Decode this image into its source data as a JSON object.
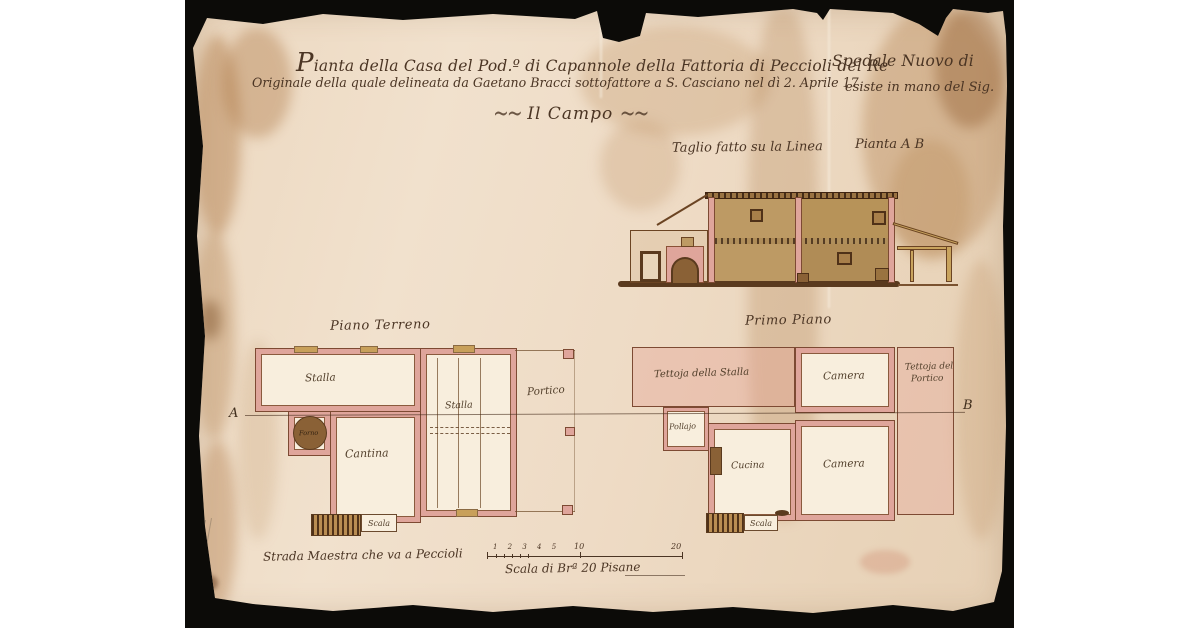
{
  "title": {
    "line1_left": "Pianta della Casa del Pod.º di Capannole della Fattoria di Peccioli del Re",
    "line1_right": "Spedale Nuovo di",
    "line2_left": "Originale della quale delineata da Gaetano Bracci sottofattore a S. Casciano nel dì 2. Aprile 17",
    "line2_right": "esiste in mano del Sig.",
    "line3": "Il Campo",
    "flourish_left": "~~",
    "flourish_right": "~~"
  },
  "section": {
    "caption_left": "Taglio fatto su la Linea",
    "caption_right": "Pianta A B"
  },
  "markers": {
    "a": "A",
    "b": "B"
  },
  "plans": {
    "ground_floor": {
      "title": "Piano Terreno",
      "rooms": {
        "stalla_left": "Stalla",
        "stalla_center": "Stalla",
        "portico": "Portico",
        "forno": "Forno",
        "cantina": "Cantina",
        "scala": "Scala"
      }
    },
    "first_floor": {
      "title": "Primo Piano",
      "rooms": {
        "tettoja_stalla": "Tettoja della Stalla",
        "camera_top": "Camera",
        "tettoja_portico_line1": "Tettoja del",
        "tettoja_portico_line2": "Portico",
        "pollajo": "Pollajo",
        "cucina": "Cucina",
        "camera_bottom": "Camera",
        "scala": "Scala"
      }
    }
  },
  "footer": {
    "road_label": "Strada Maestra che va a Peccioli",
    "scale_label": "Scala di Brª 20 Pisane",
    "scale_ticks_small": "1 2 3 4 5",
    "scale_tick_mid": "10",
    "scale_tick_end": "20"
  },
  "colors": {
    "paper": "#eedbc5",
    "mat_black": "#0c0b08",
    "ink": "#4b3524",
    "wall_pink": "#dfa59b",
    "wash_pink": "#f3d2c9",
    "masonry_tan": "#bd9a64",
    "dark_brown": "#5a3a1e"
  }
}
